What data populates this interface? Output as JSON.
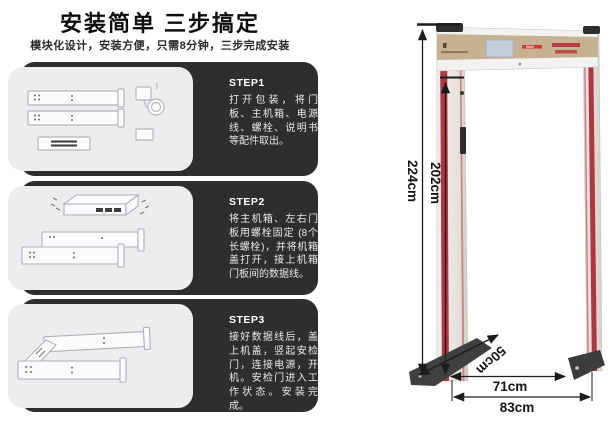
{
  "header": {
    "title": "安装简单 三步搞定",
    "subtitle": "模块化设计，安装方便，只需8分钟，三步完成安装"
  },
  "steps": [
    {
      "label": "STEP1",
      "text": "打开包装，将门板、主机箱、电源线、螺栓、说明书等配件取出。"
    },
    {
      "label": "STEP2",
      "text": "将主机箱、左右门板用螺栓固定 (8个长螺栓)，并将机箱盖打开，接上机箱门板间的数据线。"
    },
    {
      "label": "STEP3",
      "text": "接好数据线后，盖上机盖，竖起安检门，连接电源，开机。安检门进入工作状态。安装完成。"
    }
  ],
  "gate_diagram": {
    "type": "walkthrough-metal-detector",
    "dimensions": {
      "outer_height": "224cm",
      "inner_height": "202cm",
      "depth": "50cm",
      "inner_width": "71cm",
      "outer_width": "83cm"
    },
    "colors": {
      "post_stripe": "#b2353f",
      "header_panel": "#c6b291",
      "lcd_screen": "#c2ced8",
      "led_text": "#c43a42",
      "base_foot": "#3f3e40",
      "dim_line": "#1c1c1c",
      "step_panel_dark": "#2e2e30",
      "step_panel_light": "#ededef"
    }
  }
}
